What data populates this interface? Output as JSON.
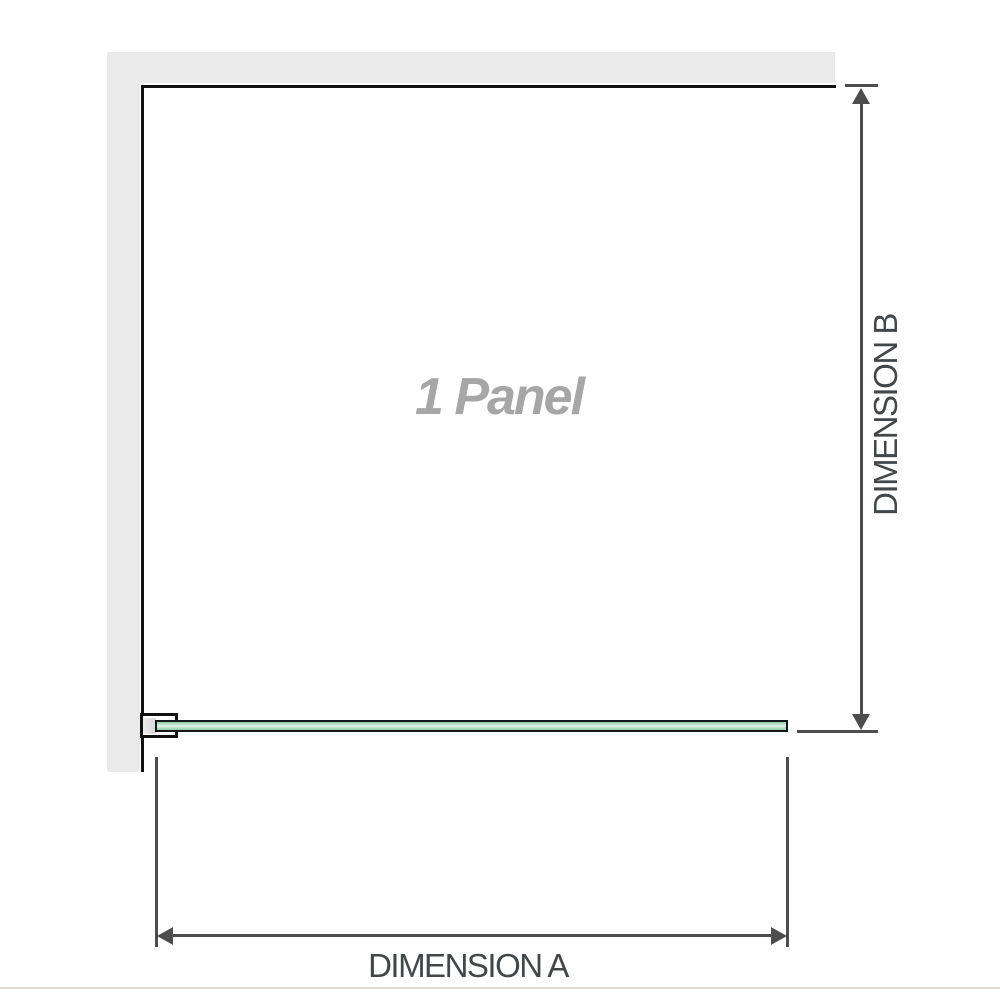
{
  "labels": {
    "panel": "1 Panel",
    "dimension_a": "DIMENSION A",
    "dimension_b": "DIMENSION B"
  },
  "colors": {
    "wall": "#eaeaea",
    "outline": "#111111",
    "dimension": "#4d4d4d",
    "dimension_text": "#43474a",
    "panel_text": "#a6a6a6",
    "glass_border": "#161616",
    "glass_edge_green": "#8fd0ab",
    "glass_center_green": "#e4f4eb",
    "bracket_pad": "#d6d6d6",
    "baseline": "#dddbd3"
  }
}
